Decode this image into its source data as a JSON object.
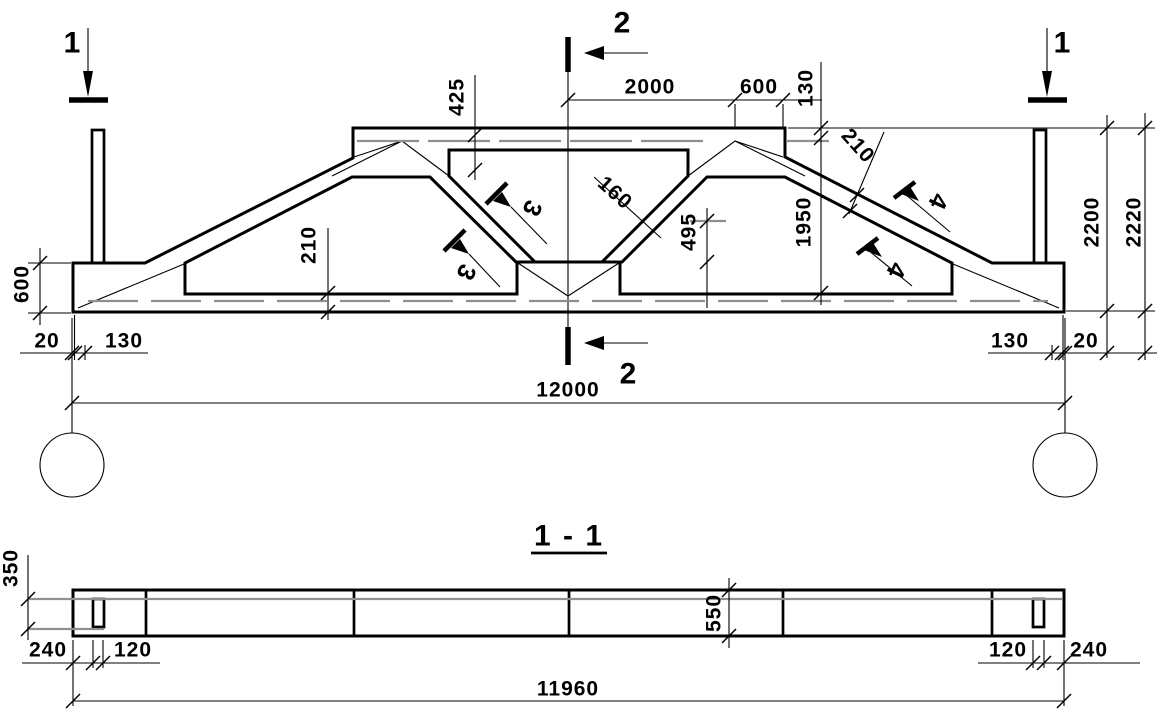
{
  "drawing": {
    "views": {
      "elevation": {
        "section_markers": {
          "m1": "1",
          "m2": "2",
          "m3": "3",
          "m4": "4"
        },
        "dimensions": {
          "top_425": "425",
          "top_2000": "2000",
          "top_600": "600",
          "top_step_130": "130",
          "chord_210_right": "210",
          "web_160": "160",
          "mid_495": "495",
          "height_1950": "1950",
          "bottom_chord_210": "210",
          "end_600": "600",
          "left_20": "20",
          "left_130": "130",
          "right_130": "130",
          "right_20": "20",
          "span_12000": "12000",
          "total_2200": "2200",
          "total_2220": "2220"
        }
      },
      "section_1_1": {
        "title": "1 - 1",
        "dimensions": {
          "end_350": "350",
          "left_240": "240",
          "left_120": "120",
          "mid_550": "550",
          "right_120": "120",
          "right_240": "240",
          "length_11960": "11960"
        }
      }
    },
    "colors": {
      "ink": "#000000",
      "reference_gray": "#8f8f8f",
      "paper": "#ffffff"
    }
  }
}
